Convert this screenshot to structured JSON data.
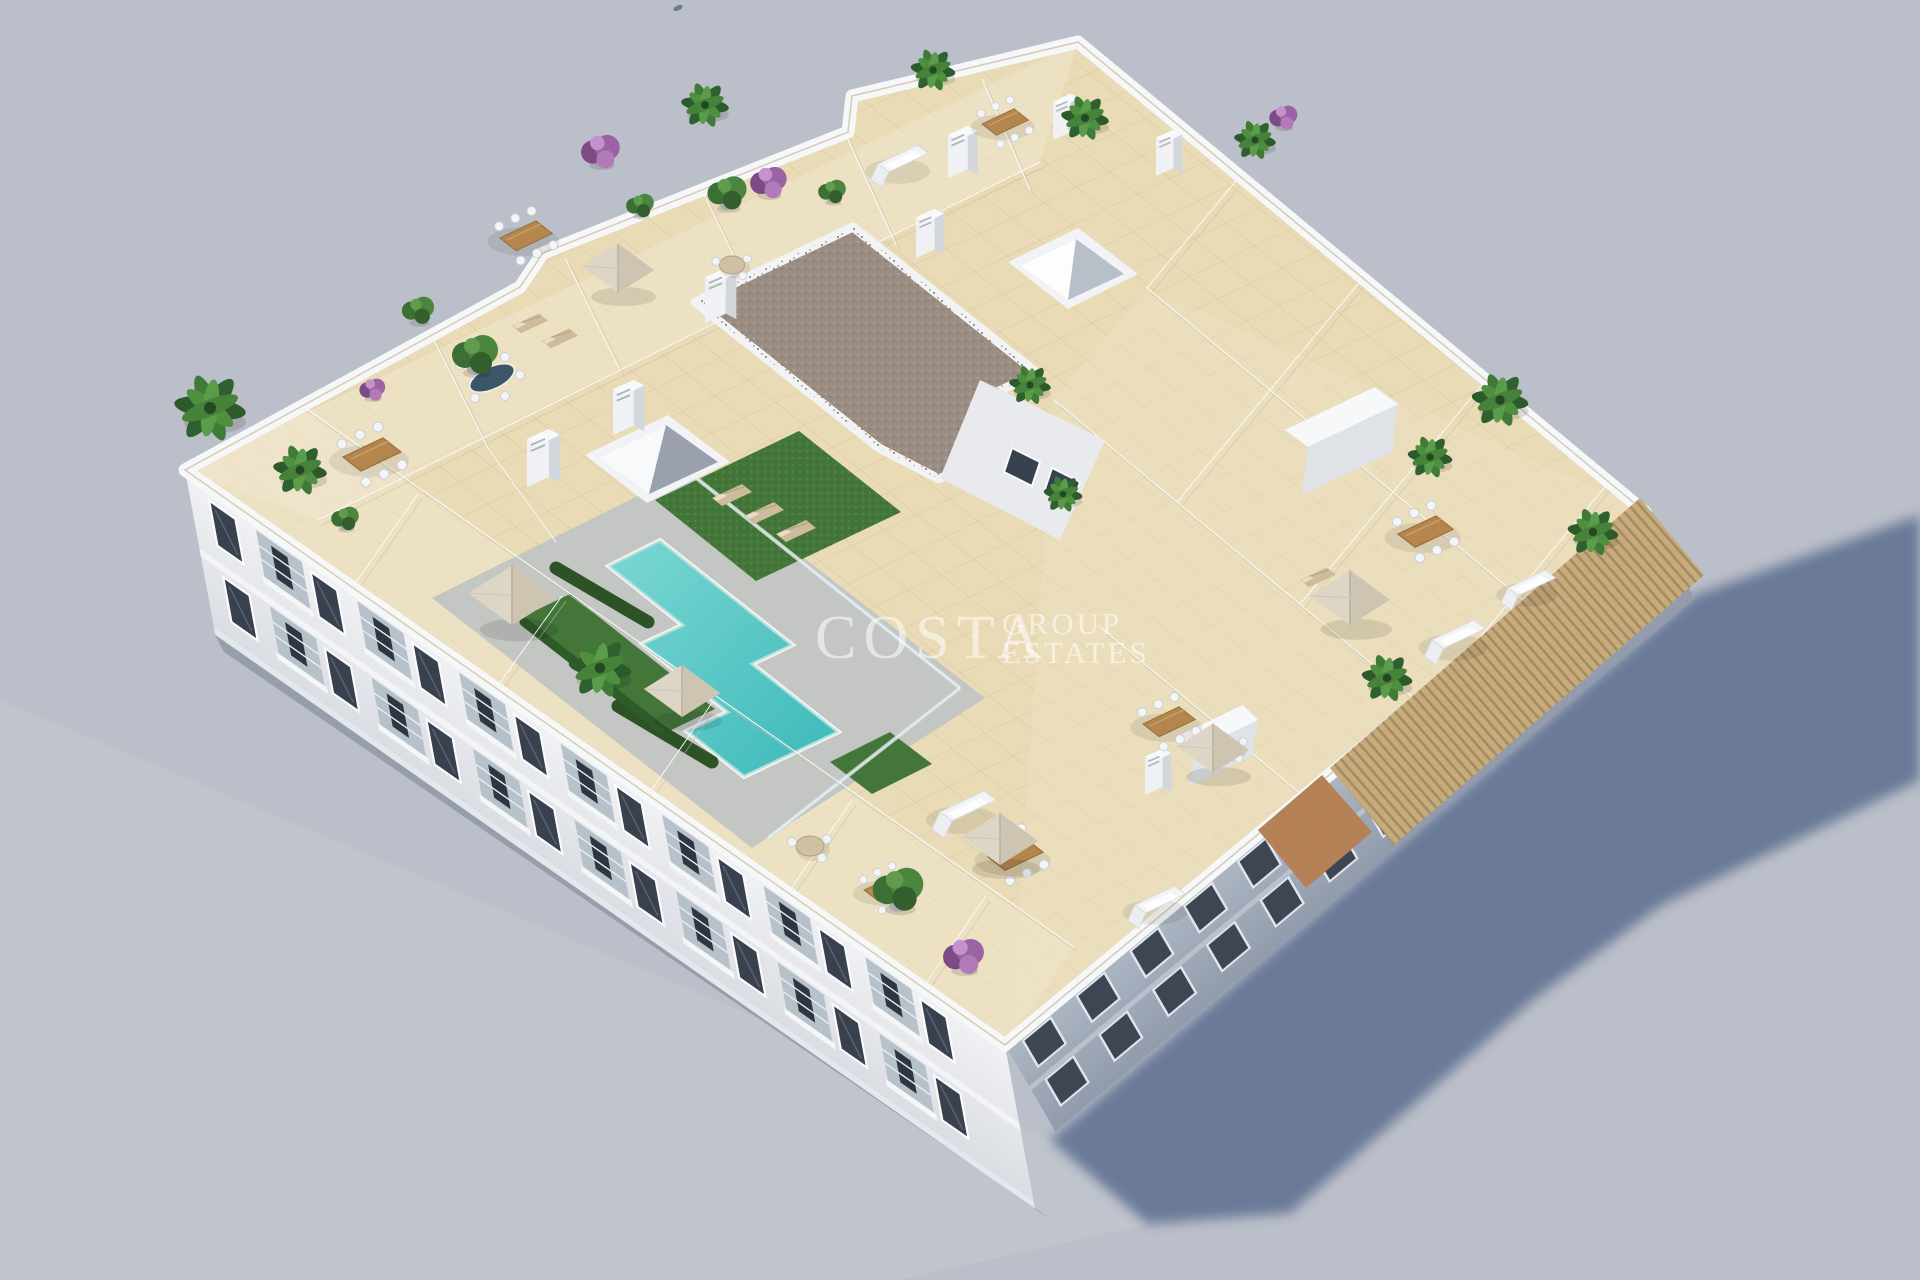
{
  "image": {
    "kind": "3d-architectural-aerial-render",
    "subject": "Aerial 3D render of the rooftop solarium of a white apartment block with communal pool, lawns, parasols and private terraces",
    "width": 1920,
    "height": 1280
  },
  "watermark": {
    "brand": "COSTA",
    "sub_line1": "GROUP",
    "sub_line2": "ESTATES"
  },
  "palette": {
    "background": "#bbbfc9",
    "ground_sunlit": "#c6c9d1",
    "ground_shadow": "#5e7191",
    "building_white": "#eef0f4",
    "facade_shaded": "#a2abb9",
    "deck_tile": "#e9dbb6",
    "tile_grout": "#d6c49a",
    "terrace_tint": "#f2e8cf",
    "pool_water": "#42c0c1",
    "pool_water_light": "#93e0da",
    "pool_deck": "#c3c6c3",
    "lawn": "#44763a",
    "hedge": "#2c5226",
    "gravel_roof": "#9c8d83",
    "pergola_slats": "#c6ab7d",
    "window_glass": "#39414e",
    "plant_dark": "#2d5a2a",
    "plant_mid": "#4c853d",
    "bougainvillea": "#9b63a4",
    "umbrella_canvas": "#ddd5c6",
    "wood_furniture": "#b5854e"
  }
}
